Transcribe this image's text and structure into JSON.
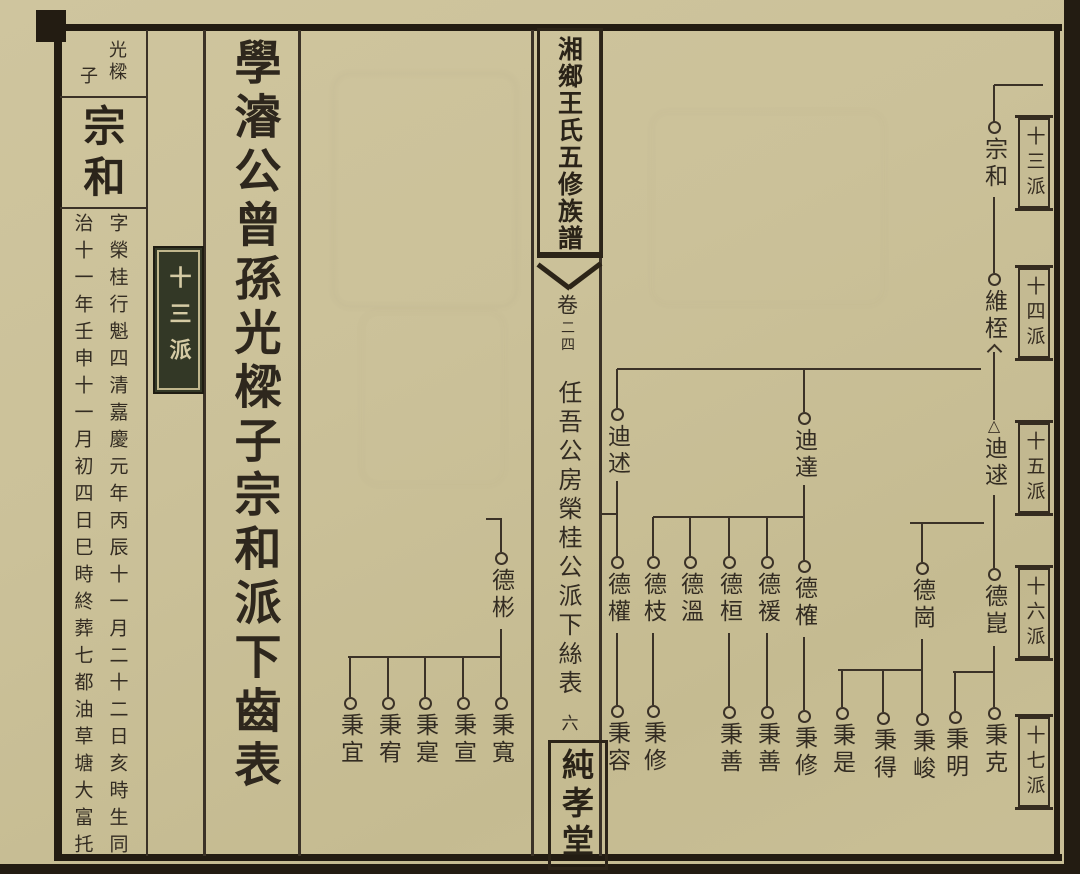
{
  "spine": {
    "book_title": "湘鄉王氏五修族譜",
    "volume_label": "卷",
    "volume_number": "二四",
    "chart_title": "任吾公房榮桂公派下絲表",
    "leaf_number": "六",
    "hall_name": "純孝堂"
  },
  "left_page": {
    "section_title": "學濬公曾孫光樑子宗和派下齒表",
    "entry": {
      "father_name": "光樑",
      "relation": "子",
      "person_name": "宗和",
      "bio_column_right": "字榮桂行魁四清嘉慶元年丙辰十一月二十二日亥時生同",
      "bio_column_left": "治十一年壬申十一月初四日巳時終葬七都油草塘大富托",
      "generation_seal": "十三派"
    }
  },
  "generation_labels": [
    {
      "label": "十三派",
      "y": 118
    },
    {
      "label": "十四派",
      "y": 268
    },
    {
      "label": "十五派",
      "y": 423
    },
    {
      "label": "十六派",
      "y": 568
    },
    {
      "label": "十七派",
      "y": 717
    }
  ],
  "tree": {
    "nodes": [
      {
        "name": "宗和",
        "x": 994,
        "y": 127,
        "marker": "circle"
      },
      {
        "name": "維桎",
        "x": 994,
        "y": 279,
        "marker": "circle"
      },
      {
        "name": "迪逑",
        "x": 994,
        "y": 426,
        "marker": "triangle"
      },
      {
        "name": "德崑",
        "x": 994,
        "y": 574,
        "marker": "circle"
      },
      {
        "name": "秉克",
        "x": 994,
        "y": 713,
        "marker": "circle"
      },
      {
        "name": "迪達",
        "x": 804,
        "y": 418,
        "marker": "circle"
      },
      {
        "name": "德榷",
        "x": 804,
        "y": 566,
        "marker": "circle"
      },
      {
        "name": "秉修",
        "x": 804,
        "y": 716,
        "marker": "circle"
      },
      {
        "name": "迪述",
        "x": 617,
        "y": 414,
        "marker": "circle"
      },
      {
        "name": "德權",
        "x": 617,
        "y": 562,
        "marker": "circle"
      },
      {
        "name": "秉容",
        "x": 617,
        "y": 711,
        "marker": "circle"
      },
      {
        "name": "德枝",
        "x": 653,
        "y": 562,
        "marker": "circle"
      },
      {
        "name": "秉修",
        "x": 653,
        "y": 711,
        "marker": "circle"
      },
      {
        "name": "德溫",
        "x": 690,
        "y": 562,
        "marker": "circle"
      },
      {
        "name": "德桓",
        "x": 729,
        "y": 562,
        "marker": "circle"
      },
      {
        "name": "秉善",
        "x": 729,
        "y": 712,
        "marker": "circle"
      },
      {
        "name": "德禐",
        "x": 767,
        "y": 562,
        "marker": "circle"
      },
      {
        "name": "秉善",
        "x": 767,
        "y": 712,
        "marker": "circle"
      },
      {
        "name": "德崗",
        "x": 922,
        "y": 568,
        "marker": "circle"
      },
      {
        "name": "秉峻",
        "x": 922,
        "y": 719,
        "marker": "circle"
      },
      {
        "name": "秉得",
        "x": 883,
        "y": 718,
        "marker": "circle"
      },
      {
        "name": "秉是",
        "x": 842,
        "y": 713,
        "marker": "circle"
      },
      {
        "name": "秉明",
        "x": 955,
        "y": 717,
        "marker": "circle"
      },
      {
        "name": "德彬",
        "x": 501,
        "y": 558,
        "marker": "circle"
      },
      {
        "name": "秉寬",
        "x": 501,
        "y": 703,
        "marker": "circle"
      },
      {
        "name": "秉宣",
        "x": 463,
        "y": 703,
        "marker": "circle"
      },
      {
        "name": "秉寔",
        "x": 425,
        "y": 703,
        "marker": "circle"
      },
      {
        "name": "秉宥",
        "x": 388,
        "y": 703,
        "marker": "circle"
      },
      {
        "name": "秉宜",
        "x": 350,
        "y": 703,
        "marker": "circle"
      }
    ],
    "segments": [
      [
        994,
        85,
        1043,
        85
      ],
      [
        994,
        85,
        994,
        122
      ],
      [
        994,
        197,
        994,
        273
      ],
      [
        994,
        352,
        994,
        420
      ],
      [
        994,
        495,
        994,
        568
      ],
      [
        994,
        646,
        994,
        707
      ],
      [
        617,
        369,
        981,
        369
      ],
      [
        617,
        369,
        617,
        408
      ],
      [
        617,
        481,
        617,
        556
      ],
      [
        599,
        514,
        618,
        514
      ],
      [
        617,
        633,
        617,
        705
      ],
      [
        804,
        369,
        804,
        412
      ],
      [
        804,
        485,
        804,
        560
      ],
      [
        653,
        517,
        805,
        517
      ],
      [
        653,
        517,
        653,
        556
      ],
      [
        690,
        517,
        690,
        556
      ],
      [
        729,
        517,
        729,
        556
      ],
      [
        767,
        517,
        767,
        556
      ],
      [
        653,
        633,
        653,
        705
      ],
      [
        729,
        633,
        729,
        706
      ],
      [
        767,
        633,
        767,
        706
      ],
      [
        804,
        637,
        804,
        710
      ],
      [
        910,
        523,
        984,
        523
      ],
      [
        922,
        523,
        922,
        562
      ],
      [
        922,
        639,
        922,
        713
      ],
      [
        838,
        670,
        922,
        670
      ],
      [
        842,
        670,
        842,
        707
      ],
      [
        883,
        670,
        883,
        712
      ],
      [
        953,
        672,
        994,
        672
      ],
      [
        955,
        672,
        955,
        711
      ],
      [
        486,
        519,
        502,
        519
      ],
      [
        501,
        519,
        501,
        552
      ],
      [
        501,
        629,
        501,
        697
      ],
      [
        348,
        657,
        501,
        657
      ],
      [
        463,
        657,
        463,
        697
      ],
      [
        425,
        657,
        425,
        697
      ],
      [
        388,
        657,
        388,
        697
      ],
      [
        350,
        657,
        350,
        697
      ]
    ],
    "adoption_arrow": {
      "x": 994,
      "y": 346
    }
  },
  "colors": {
    "paper": "#cbc199",
    "ink": "#332c22",
    "line": "#3b3227",
    "seal_background": "#333826",
    "seal_text": "#d5cba4"
  }
}
